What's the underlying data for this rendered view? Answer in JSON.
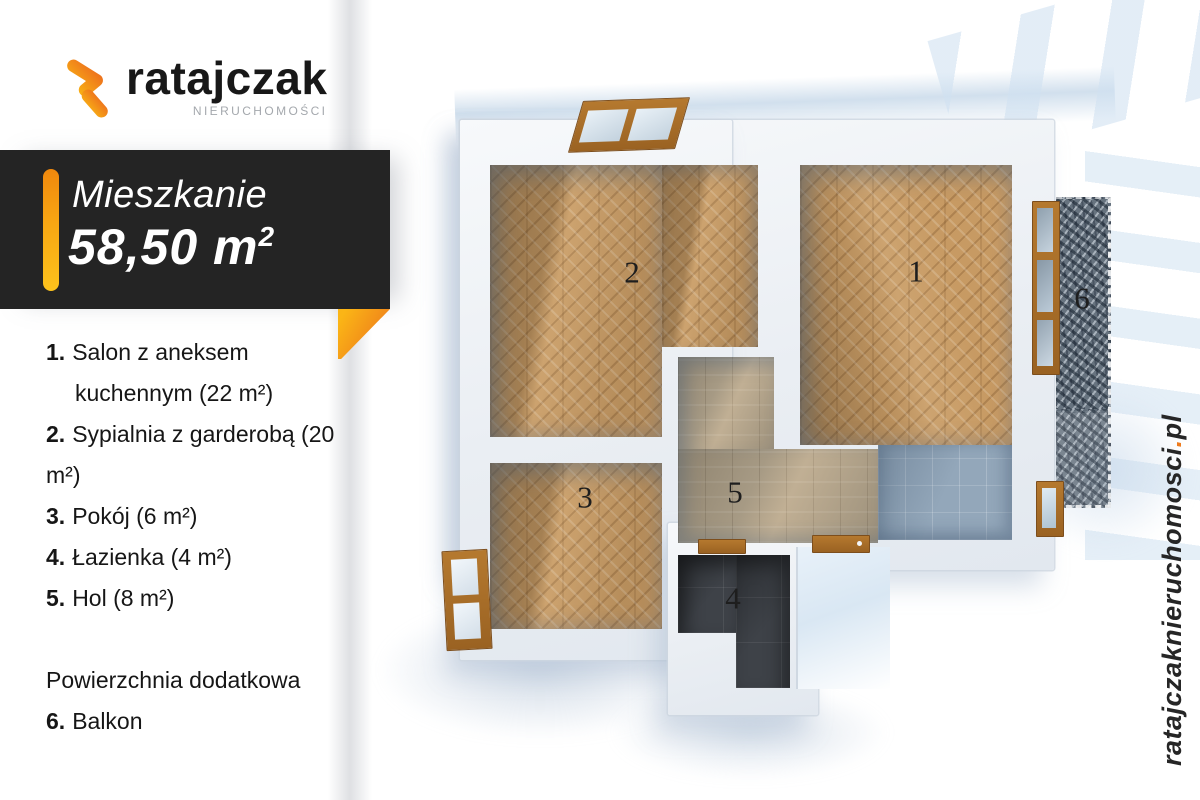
{
  "logo": {
    "name": "ratajczak",
    "subtitle": "NIERUCHOMOŚCI"
  },
  "banner": {
    "title": "Mieszkanie",
    "area_main": "58,50 m",
    "area_sup": "2"
  },
  "legend": {
    "items": [
      {
        "num": "1.",
        "text": "Salon z aneksem",
        "text2": "kuchennym (22 m²)"
      },
      {
        "num": "2.",
        "text": "Sypialnia z garderobą (20 m²)"
      },
      {
        "num": "3.",
        "text": "Pokój (6 m²)"
      },
      {
        "num": "4.",
        "text": "Łazienka (4 m²)"
      },
      {
        "num": "5.",
        "text": "Hol (8 m²)"
      }
    ],
    "extra_heading": "Powierzchnia dodatkowa",
    "extra_item": {
      "num": "6.",
      "text": "Balkon"
    }
  },
  "floorplan": {
    "rooms": [
      {
        "number": "1"
      },
      {
        "number": "2"
      },
      {
        "number": "3"
      },
      {
        "number": "4"
      },
      {
        "number": "5"
      },
      {
        "number": "6"
      }
    ]
  },
  "site": {
    "pre": "ratajczaknieruchomosci",
    "dot": ".",
    "tld": "pl"
  },
  "colors": {
    "accent_orange": "#F59B1E",
    "accent_deep_orange": "#ED6A1F",
    "banner_bg": "#242424",
    "wood_floor": "#C79A63",
    "hall_floor": "#B4A790",
    "bath_tile": "#3E4248",
    "kitchen_tile": "#93A7BA",
    "balcony_tile": "#67737F",
    "wall": "#EEF1F5"
  }
}
